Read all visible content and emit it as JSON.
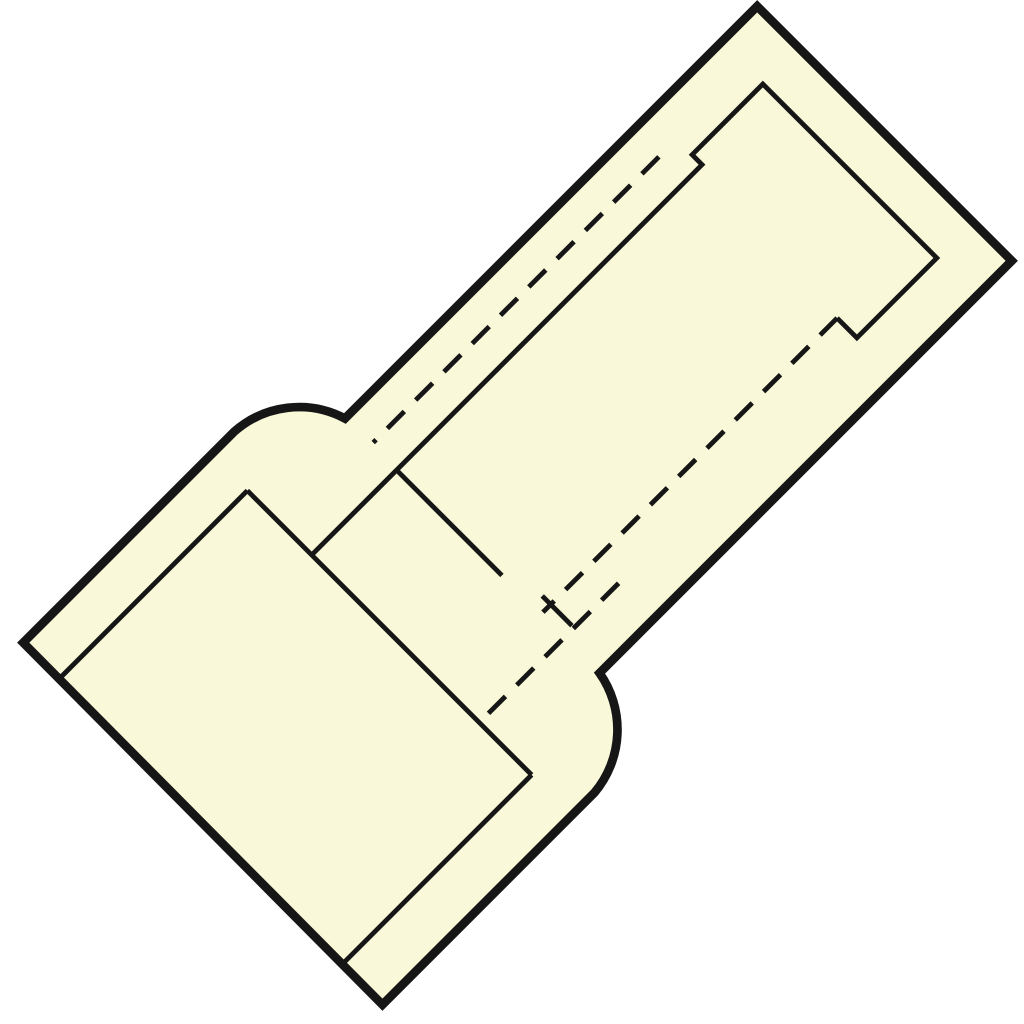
{
  "diagram": {
    "description": "technical line drawing of an insulated butt splice connector, rotated 45 degrees",
    "canvas": {
      "width": 1024,
      "height": 1024,
      "background": "#ffffff"
    },
    "colors": {
      "fill": "#F9F8D8",
      "stroke": "#161616"
    },
    "transform": {
      "translate_x": 509,
      "translate_y": 509,
      "rotate_deg": -45
    },
    "stroke_widths": {
      "outline": 8.7,
      "detail": 4.8
    },
    "dash_pattern": "24 16",
    "paths": [
      {
        "name": "connector-outer-contour",
        "role": "outline",
        "filled": true,
        "d": "M 531 -180 L -52 -180 A 98 98 0 0 0 -140 -249 L -438 -249 L -440 261 L -140 261 A 98 98 0 0 0 -52 180 L 531 180 Z"
      },
      {
        "name": "metal-tube-outline",
        "role": "detail",
        "d": "M -172 -107 L 380 -107 L 380 -121 L 480 -121 L 480 125 L 367 125 L 367 97"
      },
      {
        "name": "tube-end-face-tick-upper",
        "role": "detail",
        "d": "M -52 -107 L -52 42"
      },
      {
        "name": "tube-end-face-tick-lower",
        "role": "detail",
        "d": "M -38 85 L -38 127"
      },
      {
        "name": "sleeve-inner-end-face",
        "role": "detail",
        "d": "M -172 -198 L -172 204"
      },
      {
        "name": "sleeve-bore-upper-edge",
        "role": "detail",
        "d": "M -437 -198 L -172 -198"
      },
      {
        "name": "sleeve-bore-lower-edge",
        "role": "detail",
        "d": "M -438 204 L -172 204"
      },
      {
        "name": "hidden-bore-upper",
        "role": "hidden",
        "d": "M 355 -143 L -49 -143"
      },
      {
        "name": "hidden-bore-lower",
        "role": "hidden",
        "d": "M 367 97 L -49 97"
      },
      {
        "name": "hidden-bore-neck",
        "role": "hidden",
        "d": "M 25 130 L -172 130"
      }
    ]
  }
}
